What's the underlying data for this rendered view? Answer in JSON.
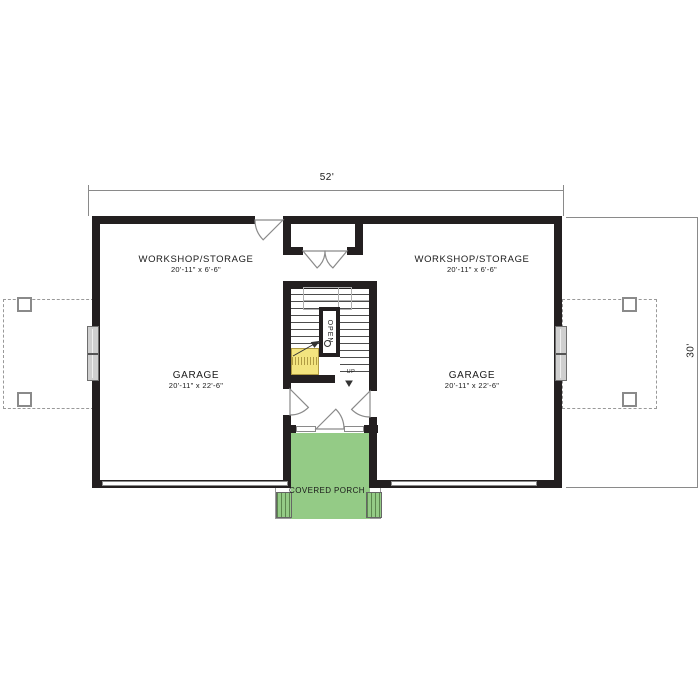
{
  "plan": {
    "title": "Garage floor plan with center stair and covered porch",
    "dimensions": {
      "width_label": "52'",
      "height_label": "30'"
    },
    "rooms": {
      "workshop_left": {
        "name": "WORKSHOP/STORAGE",
        "size": "20'-11\" x 6'-6\""
      },
      "workshop_right": {
        "name": "WORKSHOP/STORAGE",
        "size": "20'-11\" x 6'-6\""
      },
      "garage_left": {
        "name": "GARAGE",
        "size": "20'-11\" x 22'-6\""
      },
      "garage_right": {
        "name": "GARAGE",
        "size": "20'-11\" x 22'-6\""
      },
      "porch": {
        "name": "COVERED PORCH"
      }
    },
    "stair": {
      "open_label": "OPEN",
      "up_label": "UP"
    },
    "colors": {
      "wall": "#231f20",
      "dimension_lines": "#8a8a8a",
      "porch_green": "#94cb86",
      "stair_landing_yellow": "#f3e47f",
      "window_gray": "#cfcfcf"
    }
  }
}
